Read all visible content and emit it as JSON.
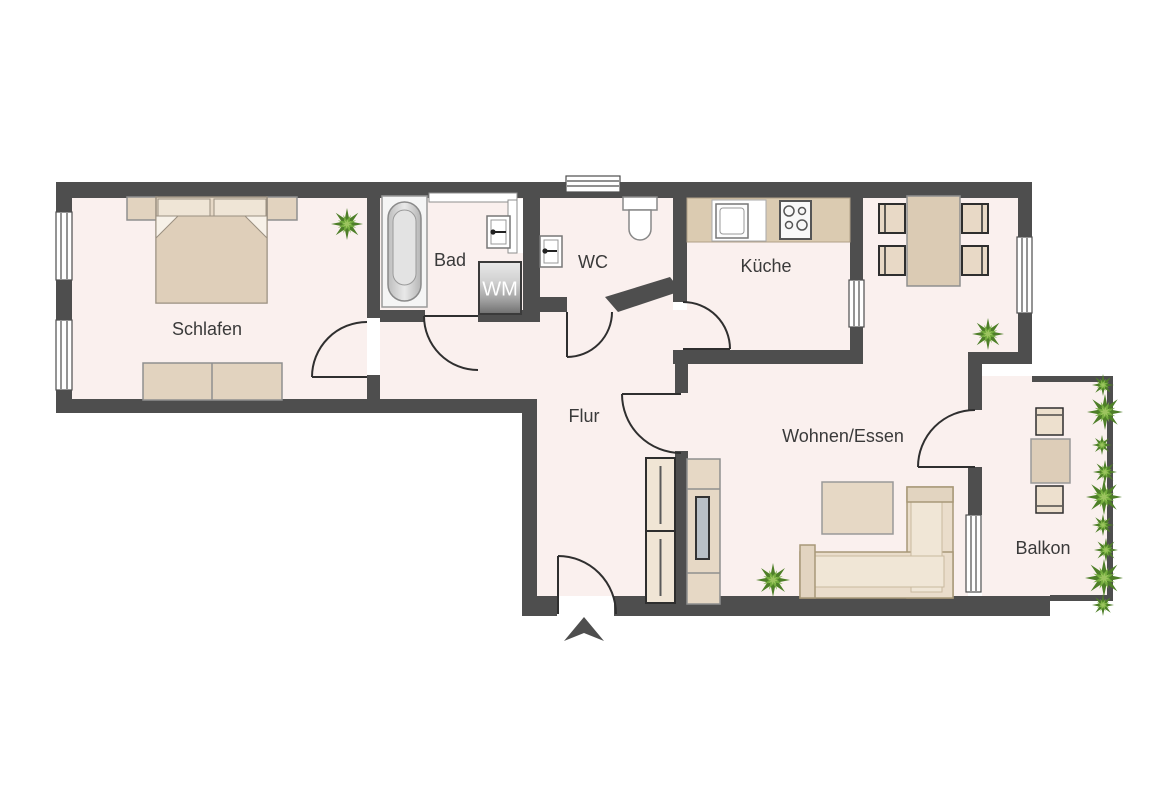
{
  "rooms": {
    "schlafen": {
      "label": "Schlafen"
    },
    "bad": {
      "label": "Bad"
    },
    "wc": {
      "label": "WC"
    },
    "kueche": {
      "label": "Küche"
    },
    "flur": {
      "label": "Flur"
    },
    "wohnen_essen": {
      "label": "Wohnen/Essen"
    },
    "balkon": {
      "label": "Balkon"
    }
  },
  "appliances": {
    "washing_machine": {
      "label": "WM"
    }
  },
  "colors": {
    "wall": "#4e4e4e",
    "floor": "#faf0ee",
    "label": "#3a3a3a",
    "furniture": "#e0d2bf",
    "plant": "#76a73c"
  }
}
